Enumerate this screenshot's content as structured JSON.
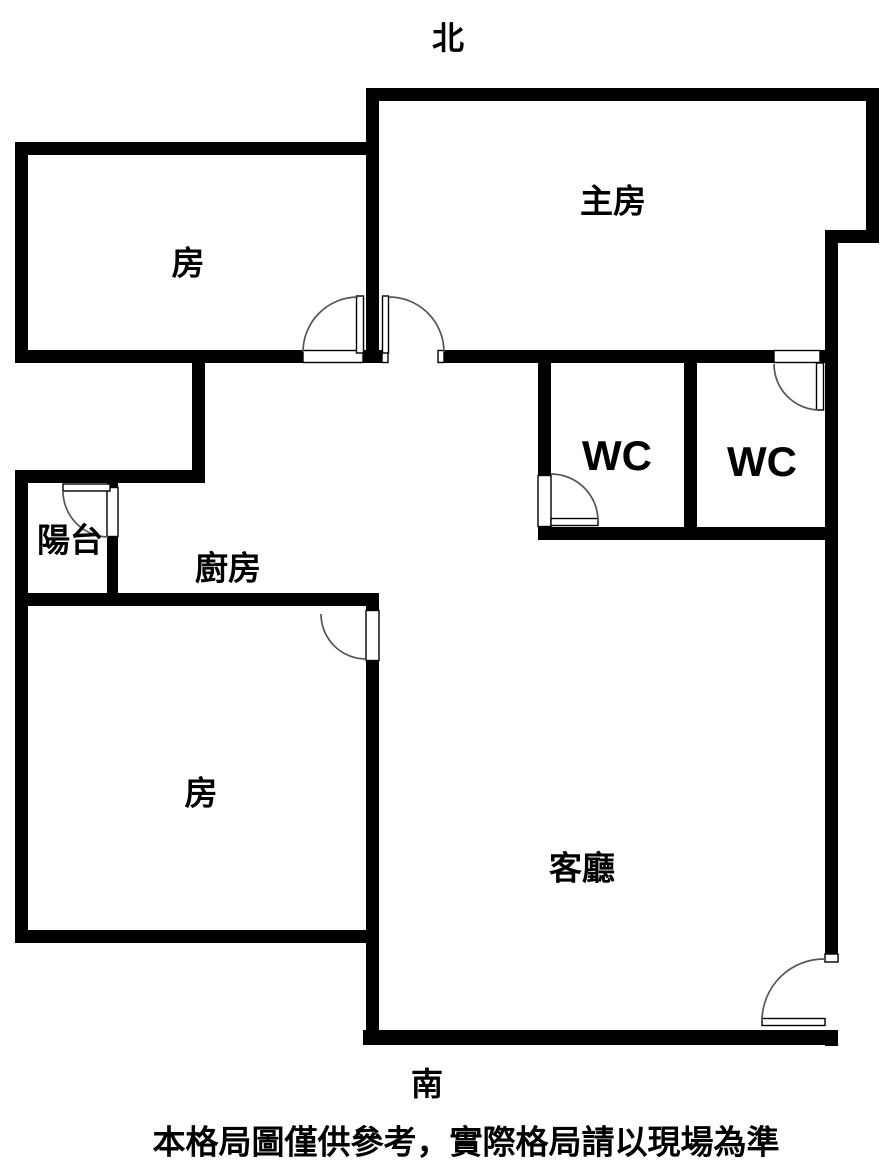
{
  "colors": {
    "wall": "#000000",
    "door_line": "#555555",
    "text": "#000000",
    "background": "#ffffff"
  },
  "compass": {
    "north": "北",
    "south": "南"
  },
  "rooms": {
    "bedroom_top_left": "房",
    "master_bedroom": "主房",
    "wc_left": "WC",
    "wc_right": "WC",
    "balcony": "陽台",
    "kitchen": "廚房",
    "bedroom_bottom_left": "房",
    "living_room": "客廳"
  },
  "disclaimer": "本格局圖僅供參考，實際格局請以現場為準"
}
